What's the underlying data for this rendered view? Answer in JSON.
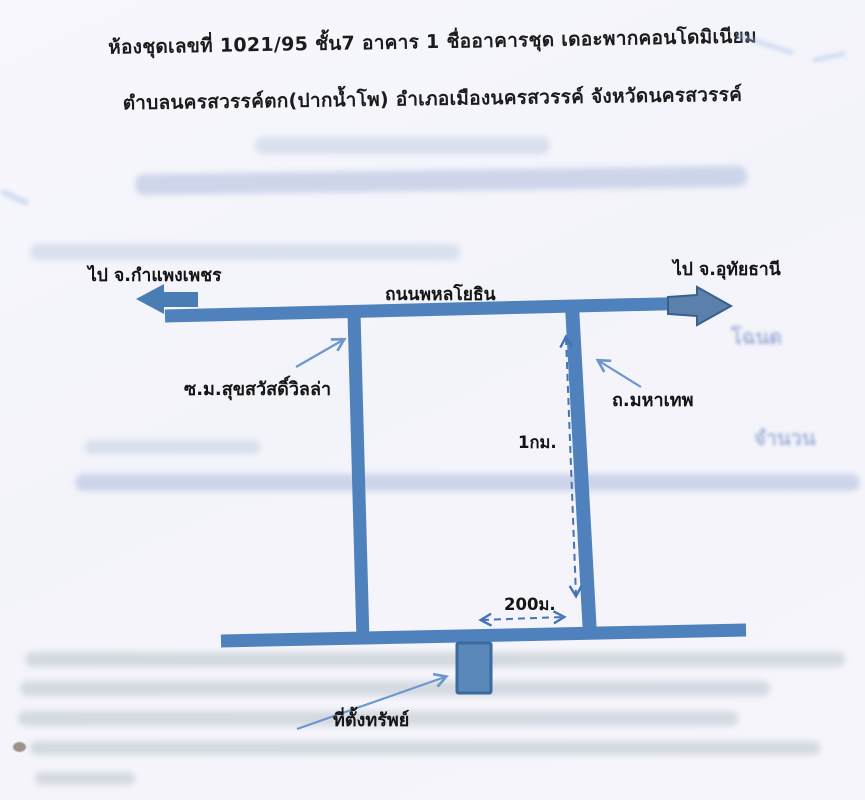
{
  "document": {
    "title_line1": "ห้องชุดเลขที่ 1021/95 ชั้น7 อาคาร 1 ชื่ออาคารชุด เดอะพากคอนโดมิเนียม",
    "title_line2": "ตำบลนครสวรรค์ตก(ปากน้ำโพ) อำเภอเมืองนครสวรรค์ จังหวัดนครสวรรค์"
  },
  "map": {
    "labels": {
      "dest_left": "ไป จ.กำแพงเพชร",
      "dest_right": "ไป จ.อุทัยธานี",
      "main_road": "ถนนพหลโยธิน",
      "soi": "ซ.ม.สุขสวัสดิ์วิลล่า",
      "cross_road": "ถ.มหาเทพ",
      "distance_vertical": "1กม.",
      "distance_horizontal": "200ม.",
      "property": "ที่ตั้งทรัพย์"
    },
    "colors": {
      "road": "#4f81bd",
      "arrow_fill": "#5a80ab",
      "arrow_outline": "#38608c",
      "dashed_line": "#4473b8",
      "annotation_arrow": "#6d96cf",
      "label_text": "#141414"
    }
  },
  "ghost_text": {
    "word_right_upper": "โฉนด",
    "word_right_lower": "จำนวน"
  }
}
